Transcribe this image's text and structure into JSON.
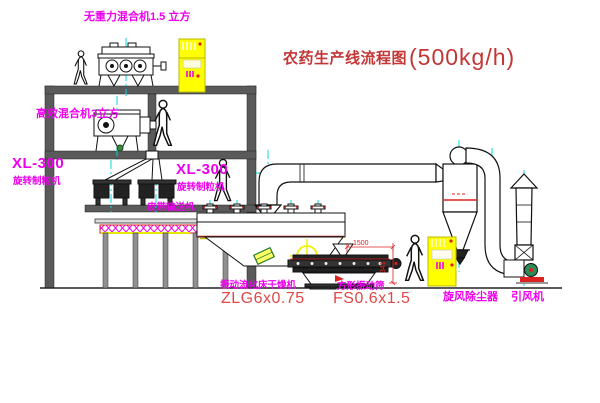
{
  "page": {
    "background": "#ffffff"
  },
  "title": {
    "text": "农药生产线流程图",
    "capacity": "(500kg/h)"
  },
  "equipment": {
    "zero_gravity_mixer": {
      "label": "无重力混合机1.5 立方"
    },
    "high_efficiency_mixer": {
      "label": "高效混合机3立方"
    },
    "granulator_left": {
      "model": "XL-300",
      "name": "旋转制粒机"
    },
    "granulator_right": {
      "model": "XL-300",
      "name": "旋转制粒机"
    },
    "belt_conveyor": {
      "name": "皮带输送机"
    },
    "fluid_bed_dryer": {
      "name": "振动流化床干燥机",
      "model": "ZLG6x0.75"
    },
    "vibrating_sieve": {
      "name": "方形振动筛",
      "model": "FS0.6x1.5",
      "dim_width": "1500",
      "dim_height": "341"
    },
    "cyclone_dust_collector": {
      "name": "旋风除尘器"
    },
    "induced_draft_fan": {
      "name": "引风机"
    }
  },
  "colors": {
    "label_magenta": "#ee00ee",
    "model_red": "#e04848",
    "title_red": "#c43535",
    "centerline_cyan": "#00dcdc",
    "cabinet_yellow": "#ffff00",
    "structure_gray": "#5a5a5a"
  }
}
